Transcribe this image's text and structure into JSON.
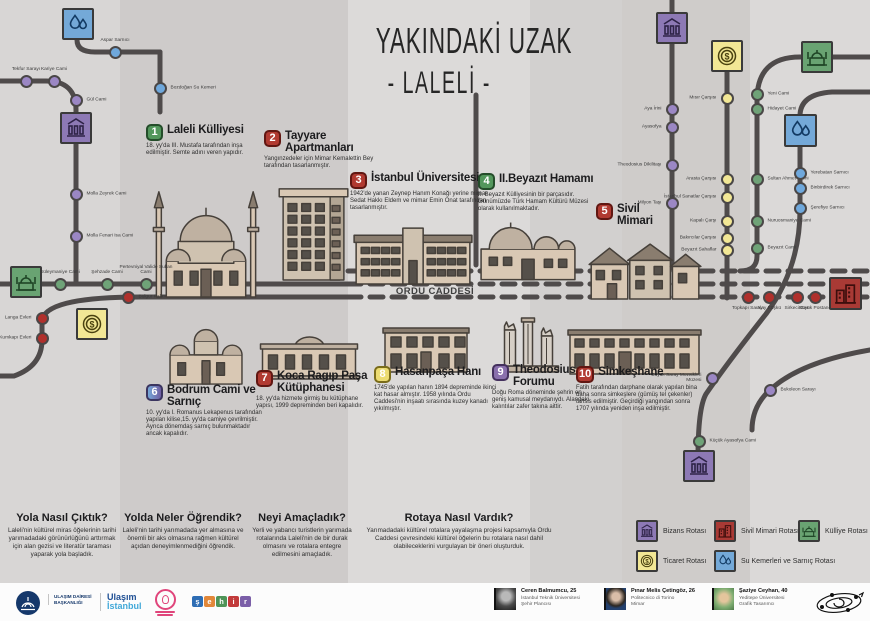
{
  "title": {
    "line1": "YAKINDAKİ UZAK",
    "line2": "- LALELİ -"
  },
  "roads": {
    "mese_odos": "MESE ODOS",
    "divan_yolu": "DIVAN YOLU",
    "ordu_caddesi": "ORDU CADDESİ"
  },
  "colors": {
    "bizans": "#8d79b5",
    "sivil": "#a93a35",
    "kulliye": "#69a372",
    "ticaret": "#f2e795",
    "water": "#74a9d8",
    "station": {
      "purple": "#9b87c4",
      "green": "#6fa378",
      "yellow": "#f2e795",
      "blue": "#6fa8dc",
      "red": "#b0302c"
    },
    "line": "#4f4b4b"
  },
  "pois": [
    {
      "num": "1",
      "color": "green",
      "title": "Laleli Külliyesi",
      "desc": "18. yy'da III. Mustafa tarafından inşa edilmiştir. Semte adını veren yapıdır.",
      "x": 146,
      "y": 124,
      "w": 118
    },
    {
      "num": "2",
      "color": "red",
      "title": "Tayyare Apartmanları",
      "desc": "Yangınzedeler için Mimar Kemalettin Bey tarafından tasarlanmıştır.",
      "x": 264,
      "y": 130,
      "w": 130
    },
    {
      "num": "3",
      "color": "red",
      "title": "İstanbul Üniversitesi",
      "desc": "1942'de yanan Zeynep Hanım Konağı yerine mimar Sedat Hakkı Eldem ve mimar Emin Onat tarafından tasarlanmıştır.",
      "x": 350,
      "y": 172,
      "w": 142
    },
    {
      "num": "4",
      "color": "green",
      "title": "II.Beyazıt Hamamı",
      "desc": "II. Beyazıt Külliyesinin bir parçasıdır. Günümüzde Türk Hamam Kültürü Müzesi olarak kullanılmaktadır.",
      "x": 478,
      "y": 173,
      "w": 128
    },
    {
      "num": "5",
      "color": "red",
      "title": "Sivil Mimari",
      "desc": "",
      "x": 596,
      "y": 203,
      "w": 70
    },
    {
      "num": "6",
      "color": "bluepurple",
      "title": "Bodrum Cami ve Sarnıç",
      "desc": "10. yy'da I. Romanus Lekapenus tarafından yapılan kilise,15. yy'da camiye çevrilmiştir. Ayrıca dönemdaş sarnıç bulunmaktadır ancak kapalıdır.",
      "x": 146,
      "y": 384,
      "w": 116
    },
    {
      "num": "7",
      "color": "red",
      "title": "Koca Ragıp Paşa Kütüphanesi",
      "desc": "18. yy'da hizmete girmiş bu kütüphane yapısı, 1999 depreminden beri kapalıdır.",
      "x": 256,
      "y": 370,
      "w": 112
    },
    {
      "num": "8",
      "color": "yellow",
      "title": "Hasanpaşa Hanı",
      "desc": "1745'de yapılan hanın 1894 depreminde ikinci kat hasar almıştır. 1958 yılında Ordu Caddesi'nin inşaatı sırasında kuzey kanadı yıkılmıştır.",
      "x": 374,
      "y": 366,
      "w": 128
    },
    {
      "num": "9",
      "color": "purple",
      "title": "Theodosius Forumu",
      "desc": "Doğu Roma döneminde şehrin en geniş kamusal meydanıydı. Alandaki kalıntılar zafer takına aittir.",
      "x": 492,
      "y": 364,
      "w": 100
    },
    {
      "num": "10",
      "color": "red",
      "title": "Simkeşhane",
      "desc": "Fatih tarafından darphane olarak yapılan bina daha sonra simkeşlere (gümüş tel çekenler) tahsis edilmiştir. Geçirdiği yangından sonra 1707 yılında yeniden inşa edilmiştir.",
      "x": 576,
      "y": 366,
      "w": 128
    }
  ],
  "illustrations": [
    {
      "type": "mosque",
      "x": 146,
      "y": 166,
      "w": 120,
      "h": 134
    },
    {
      "type": "apartment",
      "x": 266,
      "y": 184,
      "w": 96,
      "h": 98
    },
    {
      "type": "university",
      "x": 352,
      "y": 220,
      "w": 122,
      "h": 66
    },
    {
      "type": "hamam",
      "x": 477,
      "y": 210,
      "w": 102,
      "h": 72
    },
    {
      "type": "houses",
      "x": 583,
      "y": 236,
      "w": 122,
      "h": 66
    },
    {
      "type": "church",
      "x": 160,
      "y": 316,
      "w": 92,
      "h": 70
    },
    {
      "type": "library",
      "x": 256,
      "y": 322,
      "w": 106,
      "h": 58
    },
    {
      "type": "han",
      "x": 380,
      "y": 320,
      "w": 92,
      "h": 54
    },
    {
      "type": "columns",
      "x": 496,
      "y": 306,
      "w": 66,
      "h": 68
    },
    {
      "type": "simkeshane",
      "x": 566,
      "y": 322,
      "w": 137,
      "h": 54
    }
  ],
  "icon_squares": [
    {
      "type": "water",
      "x": 62,
      "y": 8,
      "s": 32
    },
    {
      "type": "bizans",
      "x": 60,
      "y": 112,
      "s": 32
    },
    {
      "type": "kulliye",
      "x": 10,
      "y": 266,
      "s": 32
    },
    {
      "type": "ticaret",
      "x": 76,
      "y": 308,
      "s": 32
    },
    {
      "type": "bizans",
      "x": 656,
      "y": 12,
      "s": 32
    },
    {
      "type": "ticaret",
      "x": 711,
      "y": 40,
      "s": 32
    },
    {
      "type": "kulliye",
      "x": 801,
      "y": 41,
      "s": 32
    },
    {
      "type": "water",
      "x": 784,
      "y": 114,
      "s": 33
    },
    {
      "type": "sivil",
      "x": 829,
      "y": 277,
      "s": 33
    },
    {
      "type": "bizans",
      "x": 683,
      "y": 450,
      "s": 32
    }
  ],
  "stations": [
    {
      "name": "Aspar Sarnıcı",
      "color": "blue",
      "x": 115,
      "y": 52,
      "side": "top"
    },
    {
      "name": "Tekfur Sarayı",
      "color": "purple",
      "x": 26,
      "y": 81,
      "side": "top"
    },
    {
      "name": "Kariye Cami",
      "color": "purple",
      "x": 54,
      "y": 81,
      "side": "top"
    },
    {
      "name": "Gül Cami",
      "color": "purple",
      "x": 76,
      "y": 100,
      "side": "right"
    },
    {
      "name": "Molla Zeyrek Cami",
      "color": "purple",
      "x": 76,
      "y": 194,
      "side": "right"
    },
    {
      "name": "Molla Fenari Isa Cami",
      "color": "purple",
      "x": 76,
      "y": 236,
      "side": "right"
    },
    {
      "name": "Süleymaniye Cami",
      "color": "green",
      "x": 60,
      "y": 284,
      "side": "top"
    },
    {
      "name": "Şehzade Cami",
      "color": "green",
      "x": 107,
      "y": 284,
      "side": "top"
    },
    {
      "name": "Pertevniyal Valide Sultan Cami",
      "color": "green",
      "x": 146,
      "y": 284,
      "side": "top"
    },
    {
      "name": "Bulgur Palas",
      "color": "red",
      "x": 128,
      "y": 297,
      "side": "right"
    },
    {
      "name": "Langa Evleri",
      "color": "red",
      "x": 42,
      "y": 318,
      "side": "left"
    },
    {
      "name": "Kumkapı Evleri",
      "color": "red",
      "x": 42,
      "y": 338,
      "side": "left"
    },
    {
      "name": "Bozdoğan Su Kemeri",
      "color": "blue",
      "x": 160,
      "y": 88,
      "side": "right"
    },
    {
      "name": "Mısır Çarşısı",
      "color": "yellow",
      "x": 727,
      "y": 98,
      "side": "left"
    },
    {
      "name": "Aya İrini",
      "color": "purple",
      "x": 672,
      "y": 109,
      "side": "left"
    },
    {
      "name": "Ayasofya",
      "color": "purple",
      "x": 672,
      "y": 127,
      "side": "left"
    },
    {
      "name": "Yeni Cami",
      "color": "green",
      "x": 757,
      "y": 94,
      "side": "right"
    },
    {
      "name": "Hidayet Cami",
      "color": "green",
      "x": 757,
      "y": 109,
      "side": "right"
    },
    {
      "name": "Theodosius Dikilitaşı",
      "color": "purple",
      "x": 672,
      "y": 165,
      "side": "left"
    },
    {
      "name": "Milyon Taşı",
      "color": "purple",
      "x": 672,
      "y": 203,
      "side": "left"
    },
    {
      "name": "Arasta Çarşısı",
      "color": "yellow",
      "x": 727,
      "y": 179,
      "side": "left"
    },
    {
      "name": "İstanbul Sanatlar Çarşısı",
      "color": "yellow",
      "x": 727,
      "y": 197,
      "side": "left"
    },
    {
      "name": "Kapalı Çarşı",
      "color": "yellow",
      "x": 727,
      "y": 221,
      "side": "left"
    },
    {
      "name": "Bakırcılar Çarşısı",
      "color": "yellow",
      "x": 727,
      "y": 238,
      "side": "left"
    },
    {
      "name": "Beyazıt Sahaflar",
      "color": "yellow",
      "x": 727,
      "y": 250,
      "side": "left"
    },
    {
      "name": "Sultan Ahmet Cami",
      "color": "green",
      "x": 757,
      "y": 179,
      "side": "right"
    },
    {
      "name": "Nuruosmaniye Cami",
      "color": "green",
      "x": 757,
      "y": 221,
      "side": "right"
    },
    {
      "name": "Beyazıt Cami",
      "color": "green",
      "x": 757,
      "y": 248,
      "side": "right"
    },
    {
      "name": "Yerebatan Sarnıcı",
      "color": "blue",
      "x": 800,
      "y": 173,
      "side": "right"
    },
    {
      "name": "Binbirdirek Sarnıcı",
      "color": "blue",
      "x": 800,
      "y": 188,
      "side": "right"
    },
    {
      "name": "Şerefiye Sarnıcı",
      "color": "blue",
      "x": 800,
      "y": 208,
      "side": "right"
    },
    {
      "name": "Topkapı Sarayı",
      "color": "red",
      "x": 748,
      "y": 297,
      "side": "bottom"
    },
    {
      "name": "Alay Köşkü",
      "color": "red",
      "x": 769,
      "y": 297,
      "side": "bottom"
    },
    {
      "name": "Sirkeci Garı",
      "color": "red",
      "x": 797,
      "y": 297,
      "side": "bottom"
    },
    {
      "name": "Büyük Postane",
      "color": "red",
      "x": 815,
      "y": 297,
      "side": "bottom"
    },
    {
      "name": "Büyük Saray Mozaikleri Müzesi",
      "color": "purple",
      "x": 712,
      "y": 378,
      "side": "left"
    },
    {
      "name": "Bukoleon Sarayı",
      "color": "purple",
      "x": 770,
      "y": 390,
      "side": "right"
    },
    {
      "name": "Küçük Ayasofya Cami",
      "color": "green",
      "x": 699,
      "y": 441,
      "side": "right"
    }
  ],
  "questions": [
    {
      "q": "Yola Nasıl Çıktık?",
      "a": "Laleli'nin kültürel miras öğelerinin tarihi yarımadadaki görünürlüğünü arttırmak için alan gezisi ve literatür taraması yaparak yola başladık."
    },
    {
      "q": "Yolda Neler Öğrendik?",
      "a": "Laleli'nin tarihi yarımadada yer almasına ve önemli bir aks olmasına rağmen kültürel açıdan deneyimlenmediğini öğrendik."
    },
    {
      "q": "Neyi Amaçladık?",
      "a": "Yerli ve yabancı turistlerin yarımada rotalarında Laleli'nin de bir durak olmasını ve rotalara entegre edilmesini amaçladık."
    },
    {
      "q": "Rotaya Nasıl Vardık?",
      "a": "Yarımadadaki kültürel rotalara yayalaşma projesi kapsamıyla Ordu Caddesi çevresindeki kültürel öğelerin bu rotalara nasıl dahil olabileceklerini vurgulayan bir öneri oluşturduk."
    }
  ],
  "legend": [
    {
      "label": "Bizans Rotası",
      "type": "bizans",
      "x": 636,
      "y": 520
    },
    {
      "label": "Sivil Mimari Rotası",
      "type": "sivil",
      "x": 714,
      "y": 520
    },
    {
      "label": "Külliye Rotası",
      "type": "kulliye",
      "x": 798,
      "y": 520
    },
    {
      "label": "Ticaret Rotası",
      "type": "ticaret",
      "x": 636,
      "y": 550
    },
    {
      "label": "Su Kemerleri ve Sarnıç Rotası",
      "type": "water",
      "x": 714,
      "y": 550
    }
  ],
  "footer": {
    "org1": "ULAŞIM DAİRESİ BAŞKANLIĞI",
    "org2a": "Ulaşım",
    "org2b": "İstanbul",
    "wordmark_letters": [
      "ş",
      "e",
      "h",
      "i",
      "r"
    ],
    "people": [
      {
        "name": "Ceren Balmumcu, 25",
        "school": "İstanbul Teknik Üniversitesi",
        "role": "Şehir Plancısı"
      },
      {
        "name": "Pınar Melis Çetingöz, 26",
        "school": "Politecnico di Torino",
        "role": "Mimar"
      },
      {
        "name": "Şaziye Ceyhan, 40",
        "school": "Yeditepe Üniversitesi",
        "role": "Grafik Tasarımcı"
      }
    ]
  }
}
